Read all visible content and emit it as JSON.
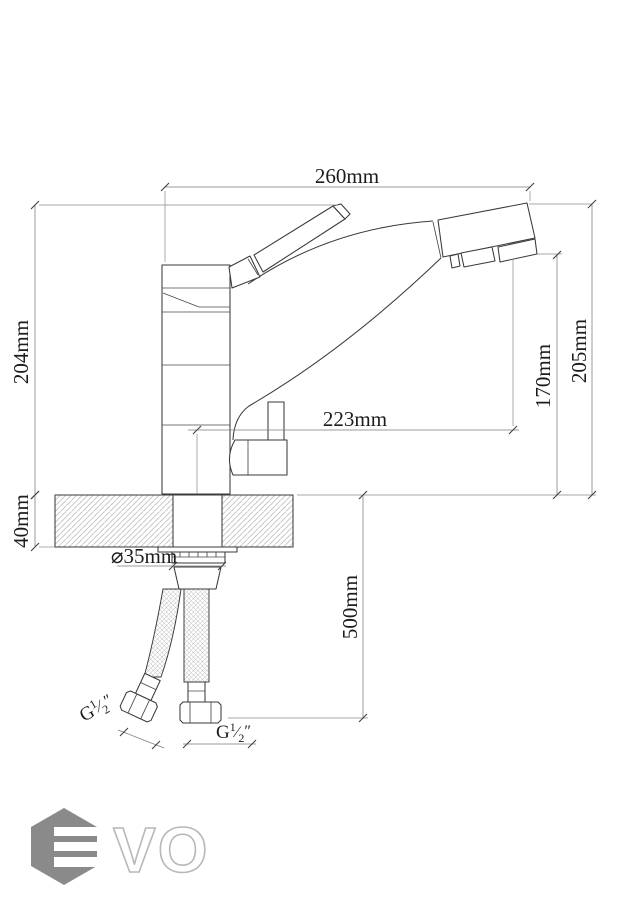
{
  "dimensions": {
    "width_top": "260mm",
    "height_overall_left": "204mm",
    "height_spout_outlet": "170mm",
    "height_overall_right": "205mm",
    "reach": "223mm",
    "deck_thickness": "40mm",
    "hole_diameter": "⌀35mm",
    "hose_length": "500mm",
    "thread": {
      "letter": "G",
      "numerator": "1",
      "denominator": "2",
      "unit": "″"
    }
  },
  "logo": {
    "brand": "EVO",
    "outline_letters": "VO",
    "hex_color": "#8a8a8a",
    "letter_outline_color": "#b8b8b8"
  },
  "colors": {
    "line": "#3a3a3a",
    "dimension": "#7a7a7a",
    "hatch": "#bdbdbd",
    "background": "#ffffff"
  }
}
